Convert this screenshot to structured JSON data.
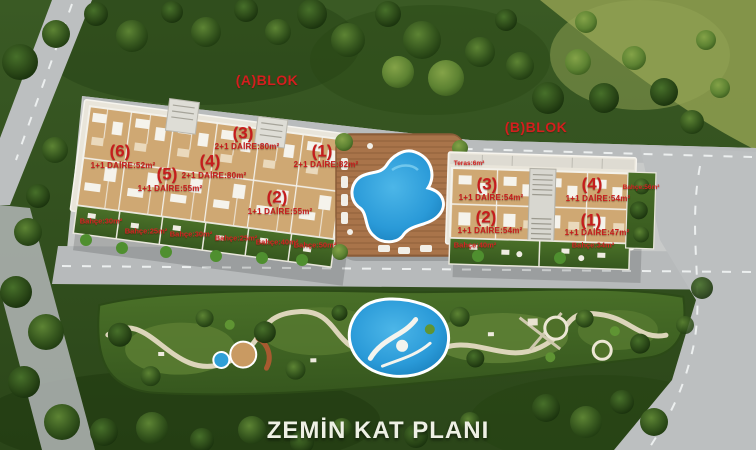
{
  "title": "ZEMİN KAT PLANI",
  "blocks": {
    "a": {
      "label": "(A)BLOK",
      "units": [
        {
          "num": "(6)",
          "info": "1+1 DAİRE:52m²"
        },
        {
          "num": "(5)",
          "info": "1+1 DAİRE:55m²"
        },
        {
          "num": "(4)",
          "info": "2+1 DAİRE:80m²"
        },
        {
          "num": "(3)",
          "info": "2+1 DAİRE:80m²"
        },
        {
          "num": "(2)",
          "info": "1+1 DAİRE:55m²"
        },
        {
          "num": "(1)",
          "info": "2+1 DAİRE:82m²"
        }
      ],
      "gardens": [
        "Bahçe:30m²",
        "Bahçe:25m²",
        "Bahçe:30m²",
        "Bahçe:25m²",
        "Bahçe:40m²",
        "Bahçe:50m²"
      ]
    },
    "b": {
      "label": "(B)BLOK",
      "terrace": "Teras:6m²",
      "units": [
        {
          "num": "(3)",
          "info": "1+1 DAİRE:54m²"
        },
        {
          "num": "(4)",
          "info": "1+1 DAİRE:54m²"
        },
        {
          "num": "(2)",
          "info": "1+1 DAİRE:54m²"
        },
        {
          "num": "(1)",
          "info": "1+1 DAİRE:47m²"
        }
      ],
      "gardens": [
        "Bahçe:40m²",
        "Bahçe:34m²"
      ],
      "side_garden": "Bahçe:56m²"
    }
  },
  "colors": {
    "label_red": "#c61d1d",
    "pool_blue": "#2a9ad8",
    "grass_green": "#33521f",
    "road_gray": "#bcbfc0",
    "wood_tan": "#cfa873",
    "title_white": "#eef0e4"
  }
}
